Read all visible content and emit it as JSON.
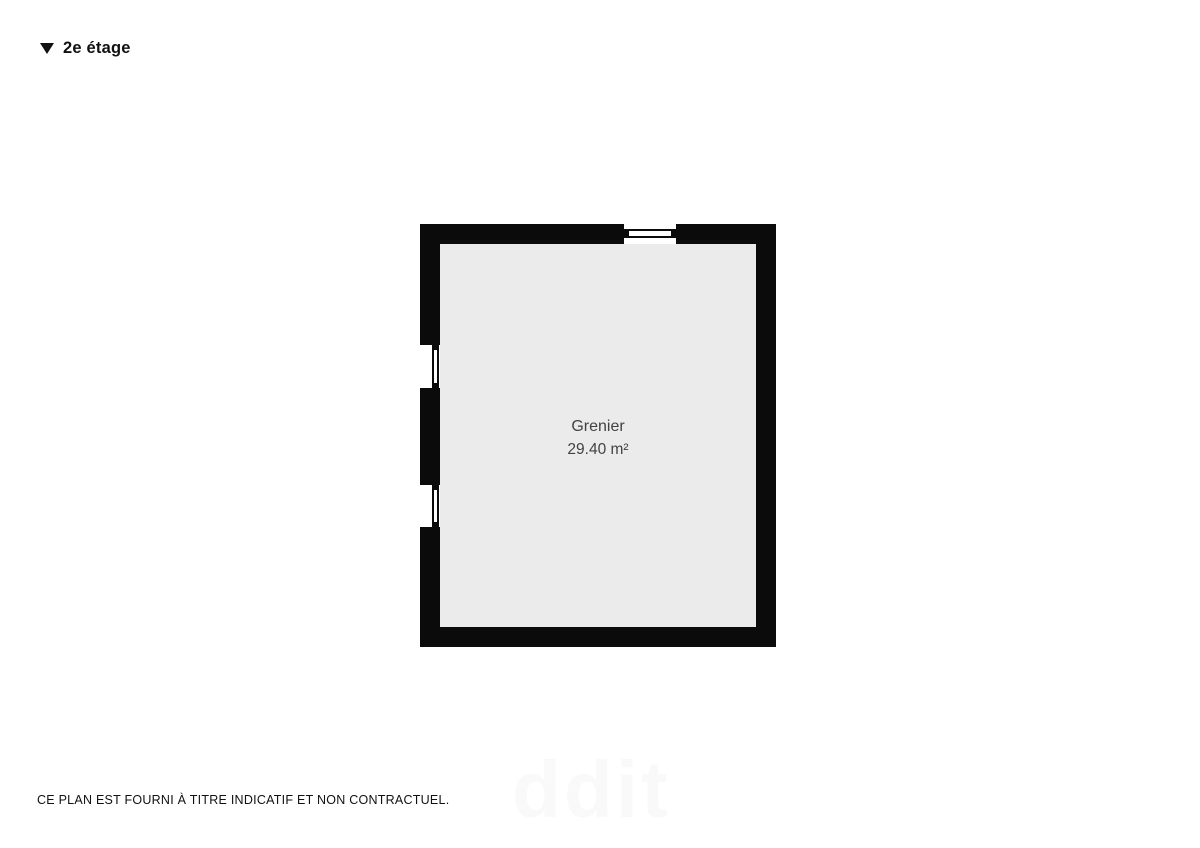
{
  "header": {
    "label": "2e étage",
    "icon": "triangle-down"
  },
  "floorplan": {
    "room": {
      "name": "Grenier",
      "area": "29.40 m²"
    },
    "windows": [
      {
        "wall": "top",
        "position": "center-right"
      },
      {
        "wall": "left",
        "position": "upper"
      },
      {
        "wall": "left",
        "position": "lower"
      }
    ]
  },
  "footer": {
    "disclaimer": "CE PLAN EST FOURNI À TITRE INDICATIF ET NON CONTRACTUEL."
  },
  "watermark": {
    "text": "ddit"
  },
  "colors": {
    "page_bg": "#ffffff",
    "wall": "#0b0b0b",
    "floor": "#ebebeb",
    "label": "#424242",
    "ink": "#111111",
    "watermark": "#f9f9f9"
  }
}
